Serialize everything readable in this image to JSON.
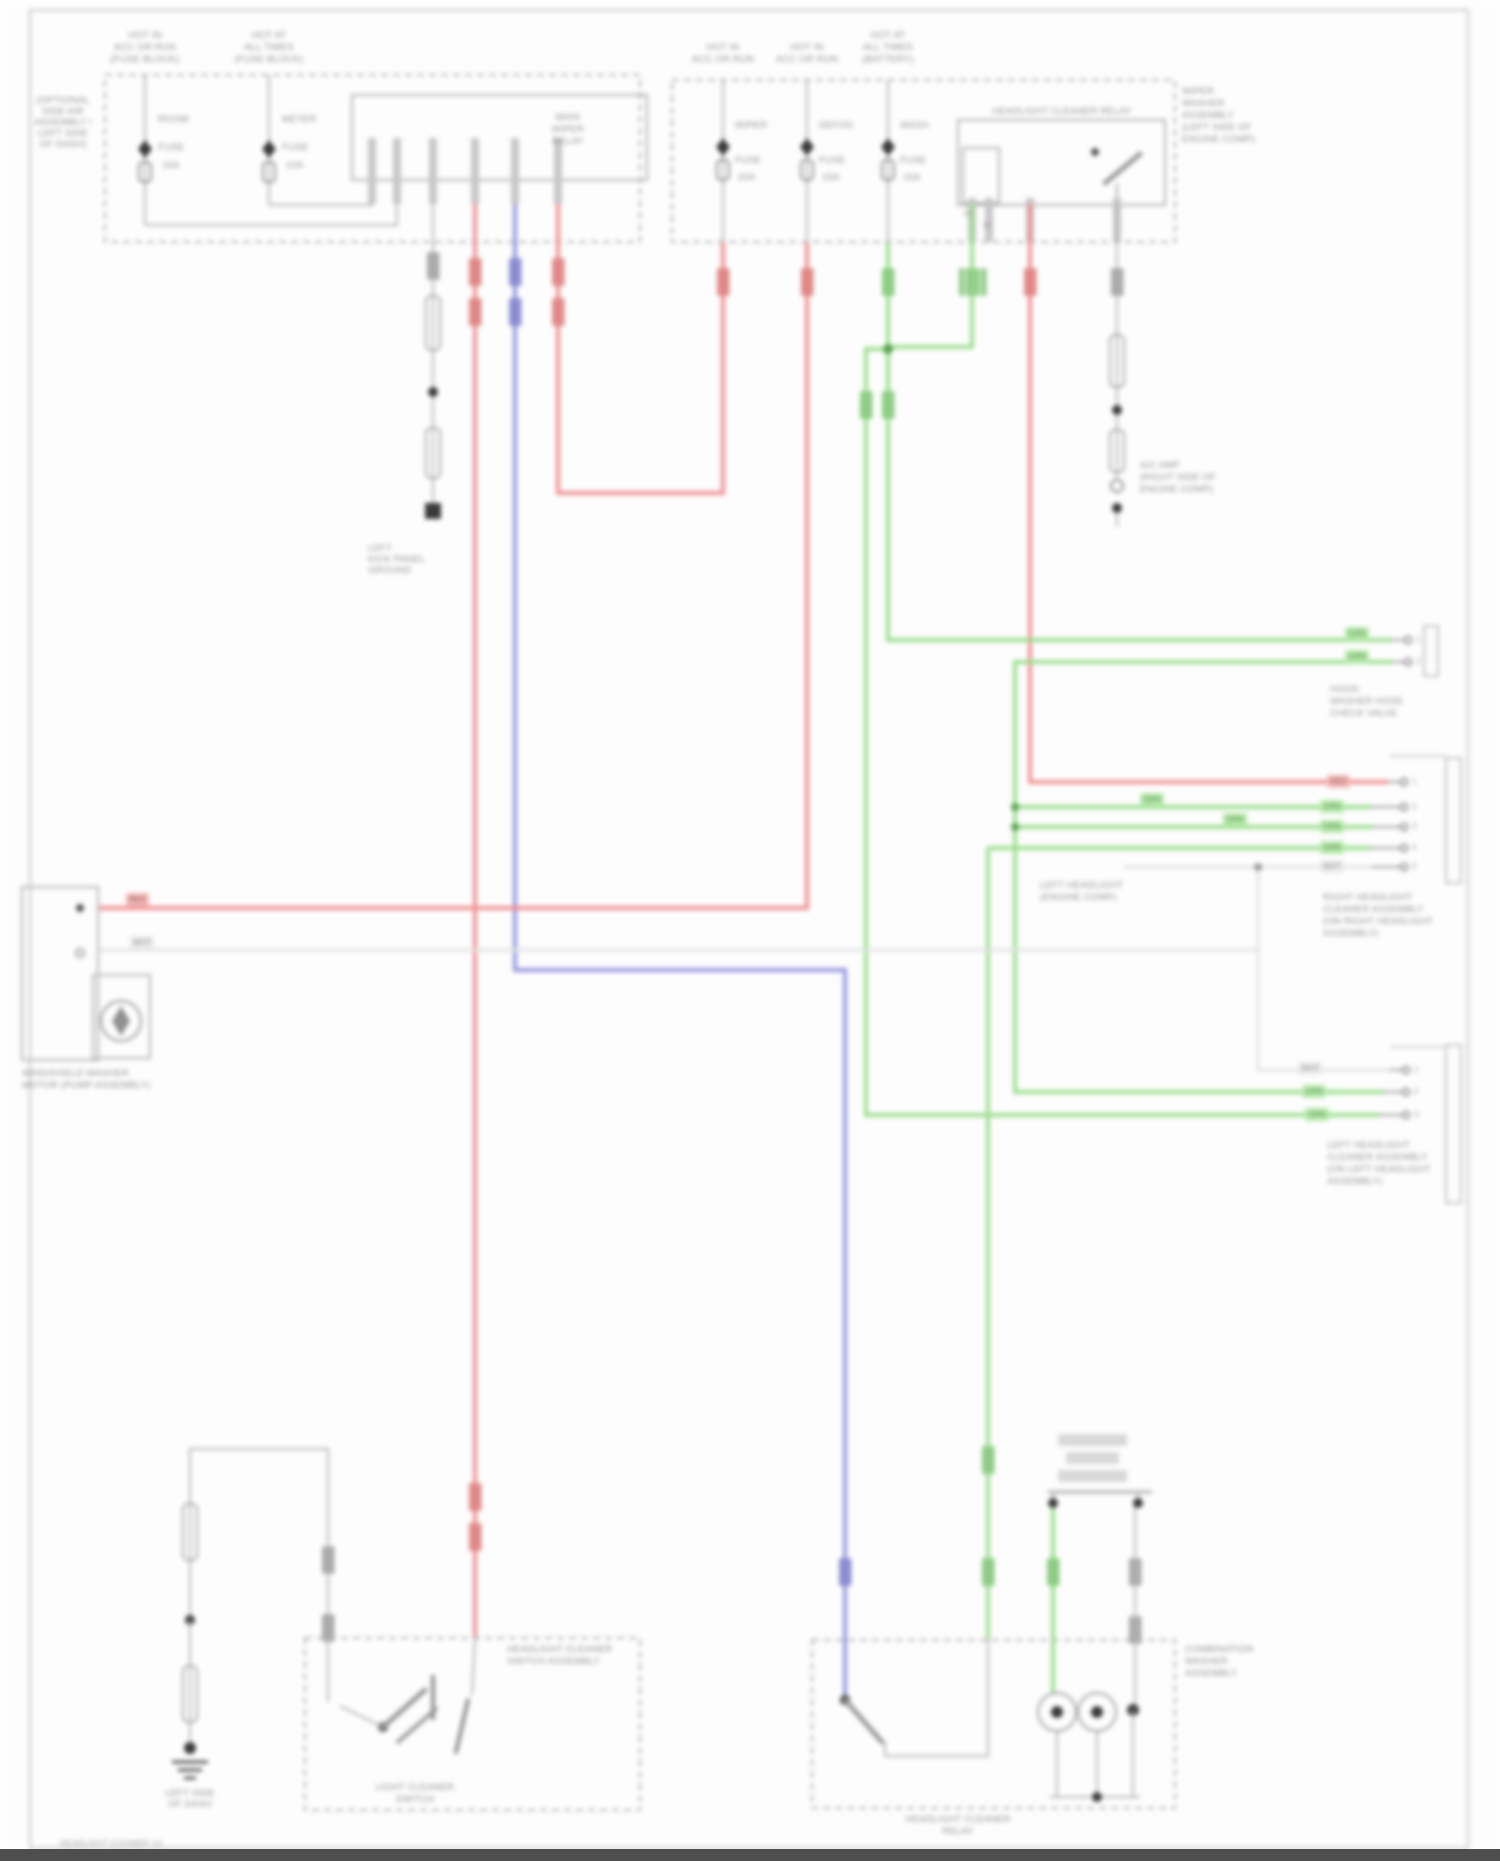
{
  "page": {
    "footer": "HEADLIGHT CLEANER 1/1"
  },
  "colors": {
    "red": "#f09090",
    "blue": "#9595e0",
    "green": "#9ade8e",
    "gray": "#b8b8b8",
    "white_wire": "#e2e2e2",
    "black": "#3a3a3a",
    "text": "#8f8f8f"
  },
  "feeds": {
    "left1": {
      "l1": "HOT IN",
      "l2": "ACC OR RUN",
      "l3": "(FUSE BLOCK)"
    },
    "left2": {
      "l1": "HOT AT",
      "l2": "ALL TIMES",
      "l3": "(FUSE BLOCK)"
    },
    "right1": {
      "l1": "HOT IN",
      "l2": "ACC OR RUN"
    },
    "right2": {
      "l1": "HOT IN",
      "l2": "ACC OR RUN"
    },
    "right3": {
      "l1": "HOT AT",
      "l2": "ALL TIMES",
      "l3": "(BATTERY)"
    }
  },
  "boxes": {
    "left": {
      "outside": {
        "l1": "(OPTIONAL",
        "l2": "SIDE AIR",
        "l3": "ASSEMBLY /",
        "l4": "LEFT SIDE",
        "l5": "OF DASH)"
      },
      "relay": {
        "l1": "MAIN",
        "l2": "WIPER",
        "l3": "RELAY"
      },
      "fuse1": {
        "name": "ROOM",
        "type": "FUSE",
        "amp": "15A"
      },
      "fuse2": {
        "name": "METER",
        "type": "FUSE",
        "amp": "10A"
      }
    },
    "right": {
      "outside": {
        "l1": "WIPER",
        "l2": "WASHER",
        "l3": "ASSEMBLY",
        "l4": "(LEFT SIDE OF",
        "l5": "ENGINE COMP)"
      },
      "relay_title": "HEADLIGHT CLEANER RELAY",
      "pin_a": "30",
      "pin_b": "85",
      "fuse1": {
        "name": "WIPER",
        "type": "FUSE",
        "amp": "20A"
      },
      "fuse2": {
        "name": "DEFOG",
        "type": "FUSE",
        "amp": "15A"
      },
      "fuse3": {
        "name": "WASH",
        "type": "FUSE",
        "amp": "15A"
      }
    }
  },
  "grounds": {
    "mid": {
      "l1": "LEFT",
      "l2": "KICK PANEL",
      "l3": "GROUND"
    },
    "bottom_left": {
      "l1": "LEFT SIDE",
      "l2": "OF DASH"
    }
  },
  "ac": {
    "l1": "A/C AMP",
    "l2": "(RIGHT SIDE OF",
    "l3": "ENGINE COMP)"
  },
  "conn_a": {
    "tag1": "GRN",
    "tag2": "GRN",
    "pin1": "1",
    "pin2": "2",
    "label": {
      "l1": "HOOD",
      "l2": "WASHER HOSE",
      "l3": "CHECK VALVE"
    }
  },
  "conn_b": {
    "tag1": "RED",
    "tag2": "GRN",
    "tag3": "GRN",
    "tag4": "GRN",
    "tag5": "WHT",
    "pin1": "1",
    "pin2": "2",
    "pin3": "3",
    "pin4": "4",
    "pin5": "5",
    "label": {
      "l1": "RIGHT HEADLIGHT",
      "l2": "CLEANER ASSEMBLY",
      "l3": "(ON RIGHT HEADLIGHT",
      "l4": "ASSEMBLY)"
    }
  },
  "conn_c": {
    "tag1": "WHT",
    "tag2": "GRN",
    "tag3": "GRN",
    "pin1": "1",
    "pin2": "2",
    "pin3": "3",
    "label": {
      "l1": "LEFT HEADLIGHT",
      "l2": "CLEANER ASSEMBLY",
      "l3": "(ON LEFT HEADLIGHT",
      "l4": "ASSEMBLY)"
    }
  },
  "mid_tags": {
    "t1": "GRN",
    "t2": "GRN"
  },
  "headlight_note": {
    "l1": "LEFT HEADLIGHT",
    "l2": "(ENGINE COMP)"
  },
  "left_box": {
    "label": {
      "l1": "WINDSHIELD WASHER",
      "l2": "MOTOR (PUMP ASSEMBLY)"
    },
    "tag_red": "RED",
    "tag_wht": "WHT"
  },
  "bl_box": {
    "inside": {
      "l1": "LIGHT CLEANER",
      "l2": "SWITCH"
    },
    "right": {
      "l1": "HEADLIGHT CLEANER",
      "l2": "SWITCH ASSEMBLY"
    }
  },
  "bm_box": {
    "right": {
      "l1": "COMBINATION",
      "l2": "WASHER",
      "l3": "ASSEMBLY"
    },
    "below": {
      "l1": "HEADLIGHT CLEANER",
      "l2": "RELAY"
    }
  }
}
